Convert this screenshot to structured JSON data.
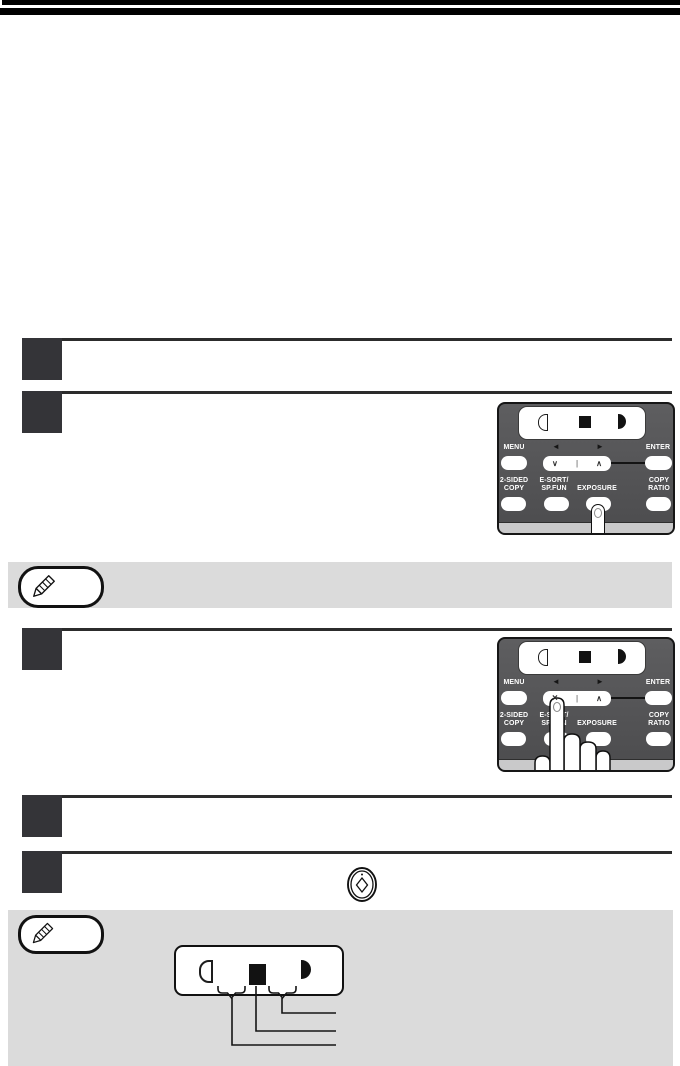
{
  "panel_labels": {
    "menu": "MENU",
    "enter": "ENTER",
    "two_sided_line1": "2-SIDED",
    "two_sided_line2": "COPY",
    "esort_line1": "E-SORT/",
    "esort_line2": "SP.FUN",
    "exposure": "EXPOSURE",
    "copy_ratio_line1": "COPY",
    "copy_ratio_line2": "RATIO"
  },
  "nav_symbols": {
    "left_arrow": "◄",
    "right_arrow": "►",
    "down": "∨",
    "divider": "|",
    "up": "∧",
    "pressed_down": "×"
  },
  "icons": {
    "note_badge": "pencil-icon",
    "start_key": "start-key-icon",
    "exposure_light": "light-exposure-icon",
    "exposure_medium": "medium-exposure-icon",
    "exposure_dark": "dark-exposure-icon"
  },
  "colors": {
    "header_bar": "#000000",
    "step_marker": "#343438",
    "rule": "#2c2c2c",
    "panel_body": "#555557",
    "panel_strip": "#c9c9ca",
    "note_bg": "#dbdbdb",
    "key_face": "#ffffff",
    "label_text": "#ffffff",
    "line": "#141414"
  }
}
